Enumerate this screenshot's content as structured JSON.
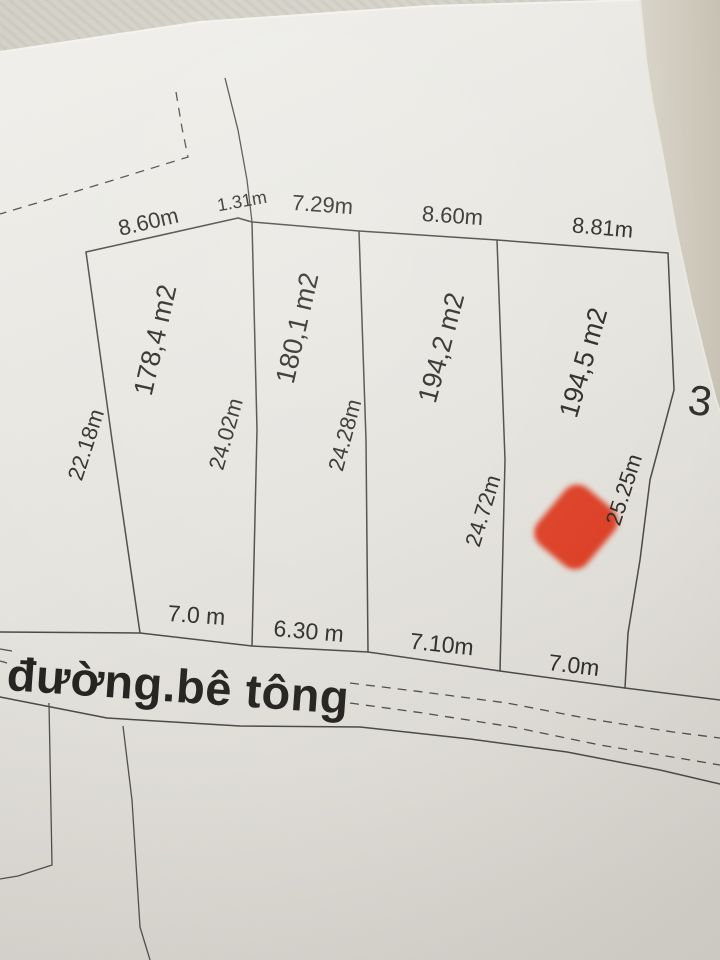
{
  "diagram": {
    "top_dimensions": [
      "8.60m",
      "1.31m",
      "7.29m",
      "8.60m",
      "8.81m"
    ],
    "areas": [
      "178,4 m2",
      "180,1 m2",
      "194,2 m2",
      "194,5 m2"
    ],
    "side_dimensions": [
      "22.18m",
      "24.02m",
      "24.28m",
      "24.72m",
      "25.25m"
    ],
    "bottom_dimensions": [
      "7.0 m",
      "6.30 m",
      "7.10m",
      "7.0m"
    ],
    "road_label": "đường.bê tông",
    "adjacent_parcel_number": "3",
    "marker_color": "#dc4126"
  }
}
